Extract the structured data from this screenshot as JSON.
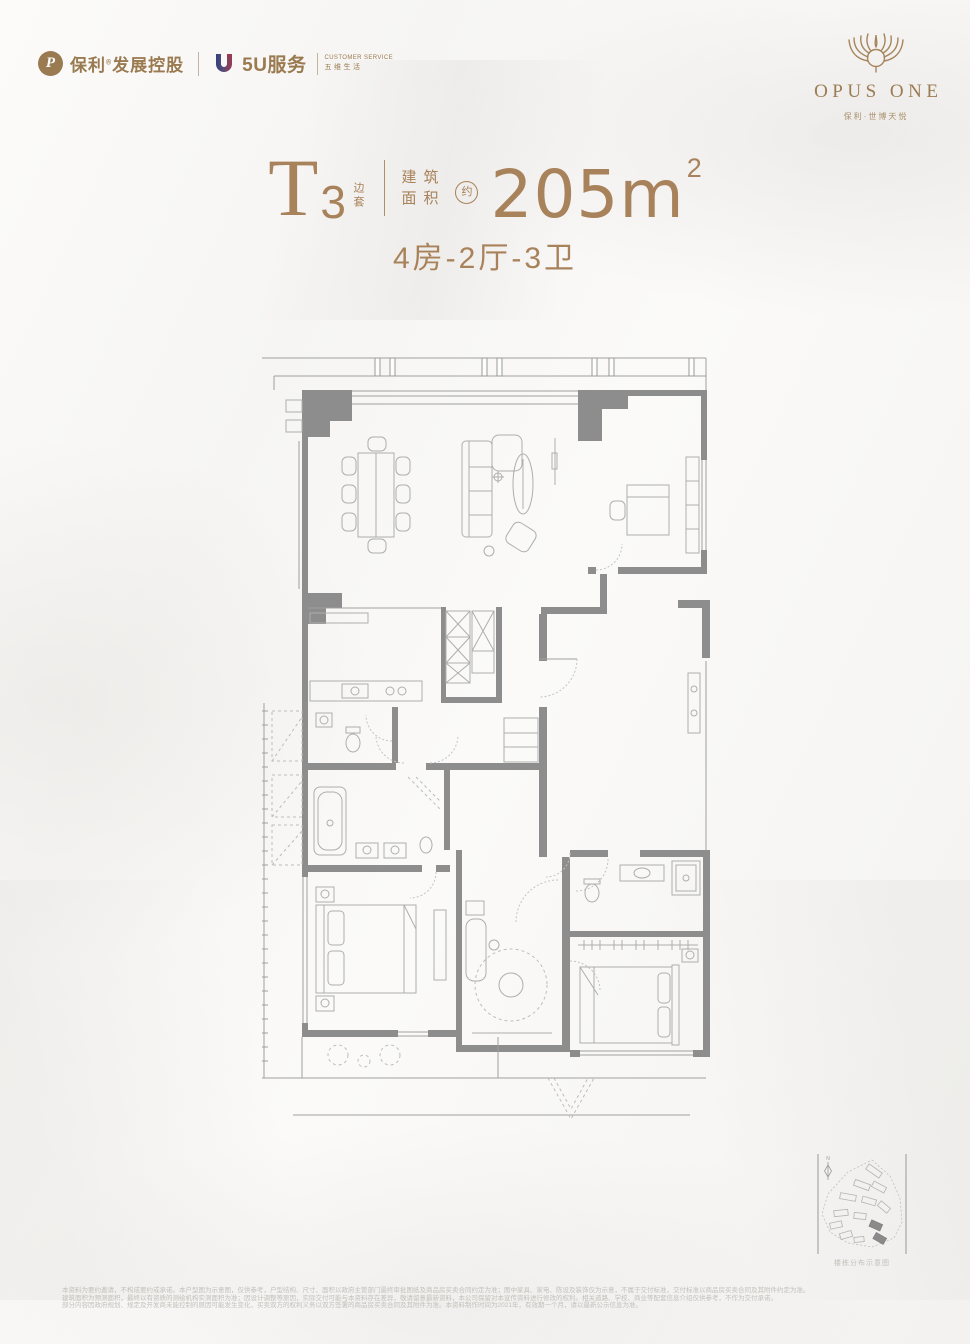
{
  "page": {
    "background": "#f8f7f5",
    "gold": "#a8825a",
    "bronze": "#9a7a50",
    "wall_gray": "#8d8d8d"
  },
  "header": {
    "poly_logo": {
      "glyph": "P",
      "brand": "保利",
      "reg_mark": "®",
      "suffix": "发展控股"
    },
    "service_logo": {
      "name": "5U服务",
      "tagline_en": "CUSTOMER SERVICE",
      "tagline_cn": "五维生活"
    }
  },
  "brand_block": {
    "emblem": "phoenix-wings-icon",
    "name": "OPUS ONE",
    "subtitle": "保利·世博天悦"
  },
  "title_block": {
    "unit_letter": "T",
    "unit_number": "3",
    "unit_tag_vertical": "边套",
    "area_label_top": "建筑",
    "area_label_bottom": "面积",
    "approx_circled": "约",
    "area_value": "205m",
    "area_superscript": "2",
    "layout_line": "4房-2厅-3卫"
  },
  "floorplan": {
    "text_labels": [],
    "symbols": [
      "dining-table-8-chairs",
      "sofa-set",
      "coffee-table",
      "tv-wall",
      "study-desk",
      "bookshelf",
      "kitchen-counter-sink-cooktop",
      "elevator-shafts",
      "entry-door-arc",
      "bathtub",
      "shower",
      "toilets",
      "double-bed-master",
      "double-bed-second",
      "walk-in-closet-rail",
      "round-rug-room",
      "balcony-chairs",
      "bay-window",
      "ac-equipment-bays"
    ]
  },
  "siteplan": {
    "compass_label": "N",
    "caption": "楼栋分布示意图"
  },
  "disclaimer": {
    "lines": [
      "本资料为要约邀请，不构成要约或承诺。本户型图为示意图，仅供参考，户型结构、尺寸、面积以政府主管部门最终审批图纸及商品房买卖合同约定为准；图中家具、家电、陈设及装饰仅为示意，不属于交付标准，交付标准以商品房买卖合同及其附件约定为准。",
      "建筑面积为预测面积，最终以有资质的测绘机构实测面积为准；因设计调整等原因，实际交付可能与本资料存在差异，敬请留意最新资料，本公司保留对本宣传资料进行修改的权利。相关道路、学校、商业等配套信息介绍仅供参考，不作为交付承诺。",
      "部分内容因政府规划、规定及开发商未能控制的原因可能发生变化，买卖双方的权利义务以双方签署的商品房买卖合同及其附件为准。本资料制作时间为2021年，有效期一个月，请以最新公示信息为准。"
    ]
  }
}
